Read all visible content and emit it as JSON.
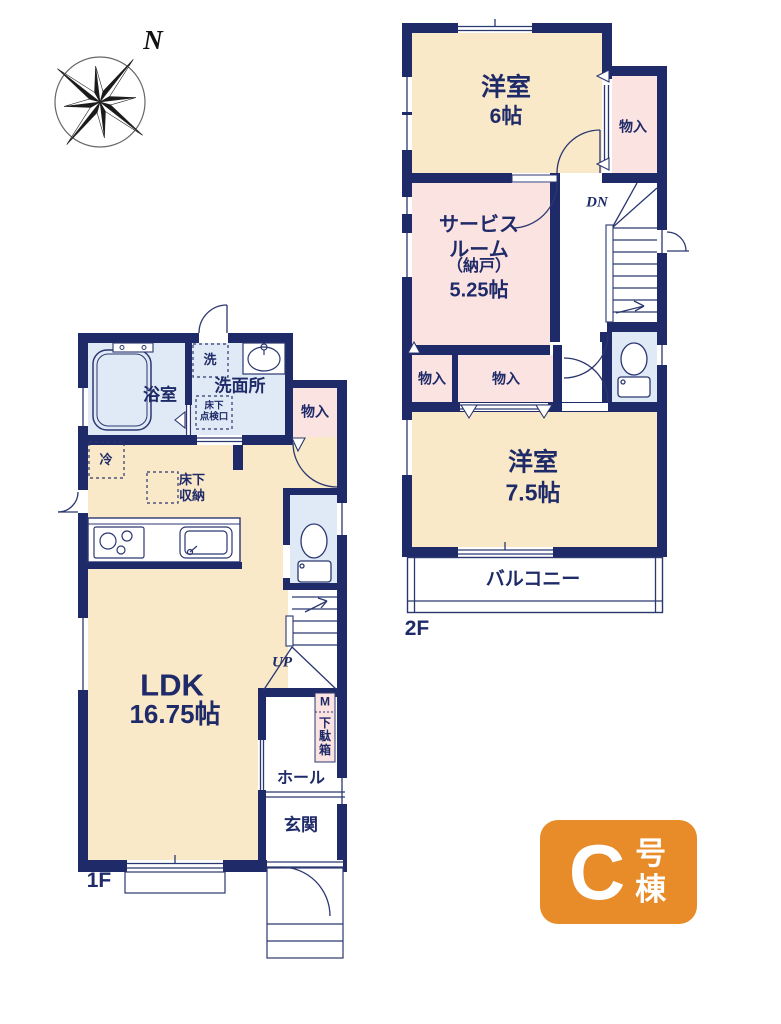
{
  "colors": {
    "wall": "#1f2a68",
    "line": "#2b3770",
    "room_cream": "#f9e9c8",
    "room_pink": "#fbe3e2",
    "room_blue": "#dfeaf6",
    "badge_orange": "#e88b29",
    "text": "#1f2a68"
  },
  "compass": {
    "north": "N"
  },
  "floor2": {
    "label": "2F",
    "bedroom6": {
      "name": "洋室",
      "area": "6帖"
    },
    "closet_top": {
      "label": "物入"
    },
    "service_room": {
      "name": "サービス\nルーム",
      "subname": "（納戸）",
      "area": "5.25帖"
    },
    "stairs": {
      "label": "DN"
    },
    "closet_a": {
      "label": "物入"
    },
    "closet_b": {
      "label": "物入"
    },
    "bedroom75": {
      "name": "洋室",
      "area": "7.5帖"
    },
    "balcony": {
      "label": "バルコニー"
    }
  },
  "floor1": {
    "label": "1F",
    "bathroom": {
      "label": "浴室"
    },
    "washer": {
      "label": "洗"
    },
    "washroom": {
      "label": "洗面所"
    },
    "inspection_hatch": {
      "label": "床下\n点検口"
    },
    "closet": {
      "label": "物入"
    },
    "fridge": {
      "label": "冷"
    },
    "underfloor_storage": {
      "label": "床下\n収納"
    },
    "ldk": {
      "name": "LDK",
      "area": "16.75帖"
    },
    "stairs": {
      "label": "UP"
    },
    "meter": {
      "label": "M"
    },
    "shoe_cabinet": {
      "label": "下駄箱"
    },
    "hall": {
      "label": "ホール"
    },
    "entrance": {
      "label": "玄関"
    }
  },
  "badge": {
    "unit": "C",
    "suffix": "号棟"
  }
}
